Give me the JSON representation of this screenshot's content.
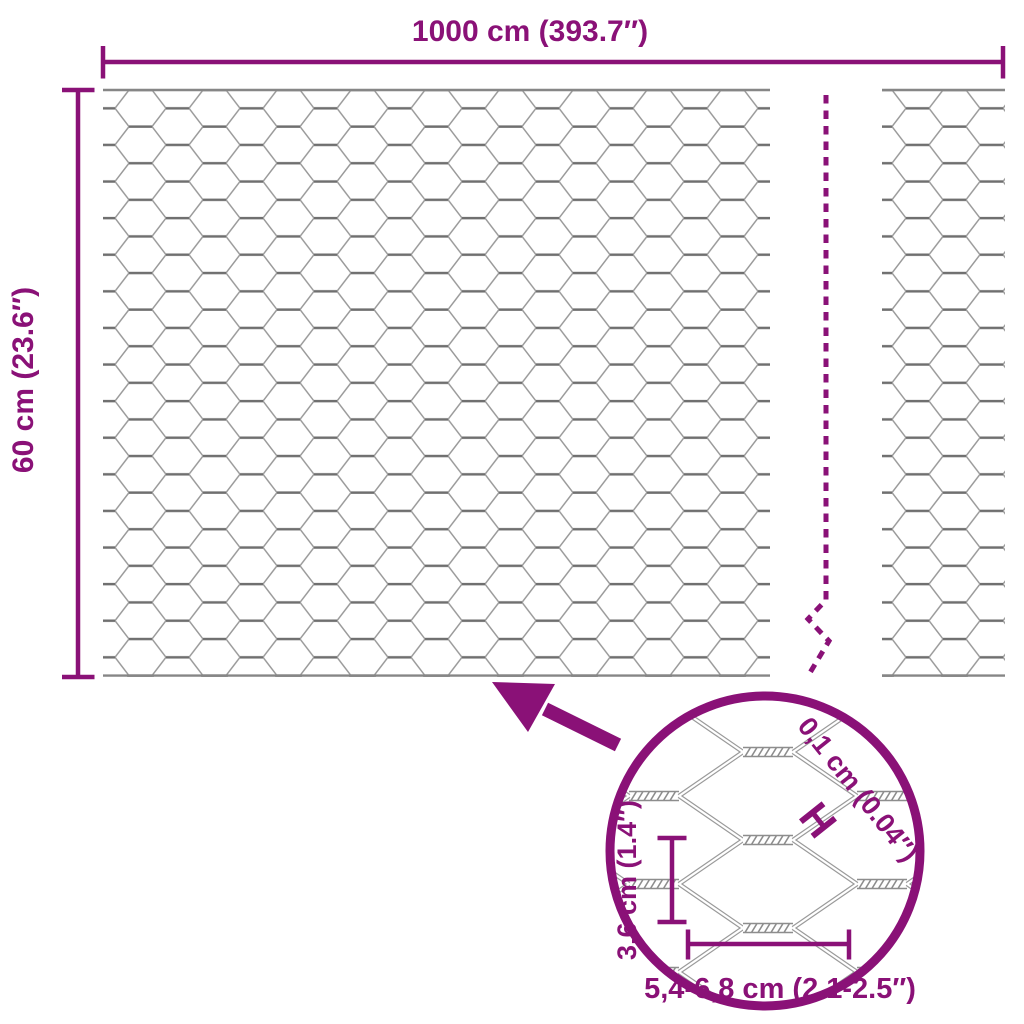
{
  "accent_color": "#8A1177",
  "mesh_color": "#9a9a9a",
  "mesh_twist_color": "#6f6f6f",
  "top_dimension": {
    "label": "1000 cm (393.7″)"
  },
  "side_dimension": {
    "label": "60 cm (23.6″)"
  },
  "detail_view": {
    "wire_diameter_label": "0,1 cm (0.04″)",
    "wire_diameter_marker": "H",
    "mesh_height_label": "3,6 cm (1.4″)",
    "mesh_width_label": "5,4-6,8 cm (2.1-2.5″)"
  }
}
